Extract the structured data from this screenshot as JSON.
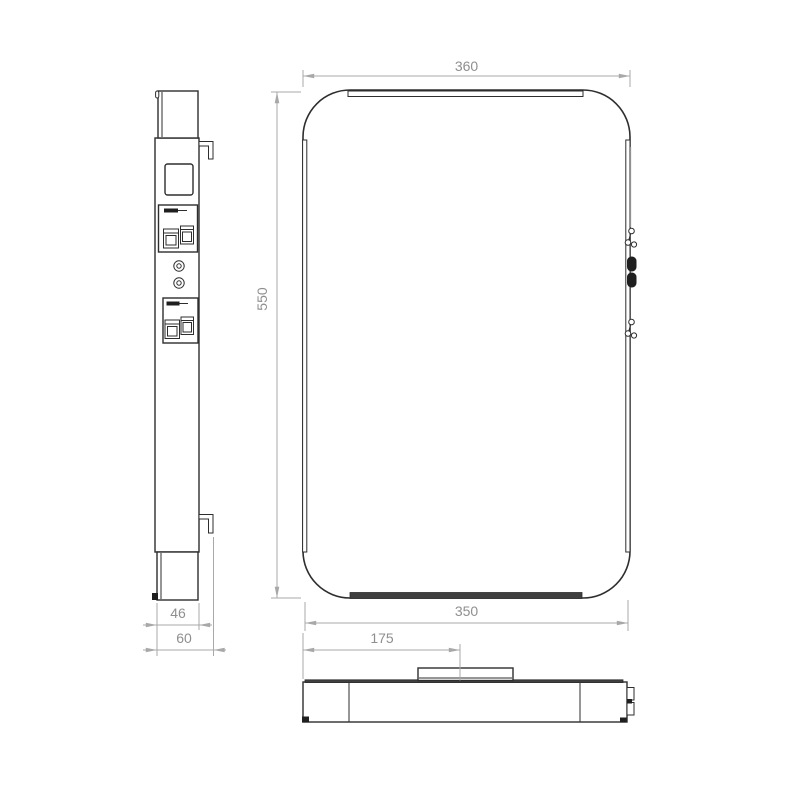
{
  "drawing": {
    "kind": "technical-dimension-drawing",
    "dims": {
      "front_width": "360",
      "front_height": "550",
      "front_bottom_width": "350",
      "side_depth_inner": "46",
      "side_depth_total": "60",
      "mount_offset": "175"
    },
    "colors": {
      "line": "#2e2e2e",
      "dim_line": "#a8a8a8",
      "dim_text": "#8f8f8f",
      "fill_dark": "#1f1f1f",
      "strip_dark": "#3f3f3f",
      "background": "#ffffff"
    }
  }
}
